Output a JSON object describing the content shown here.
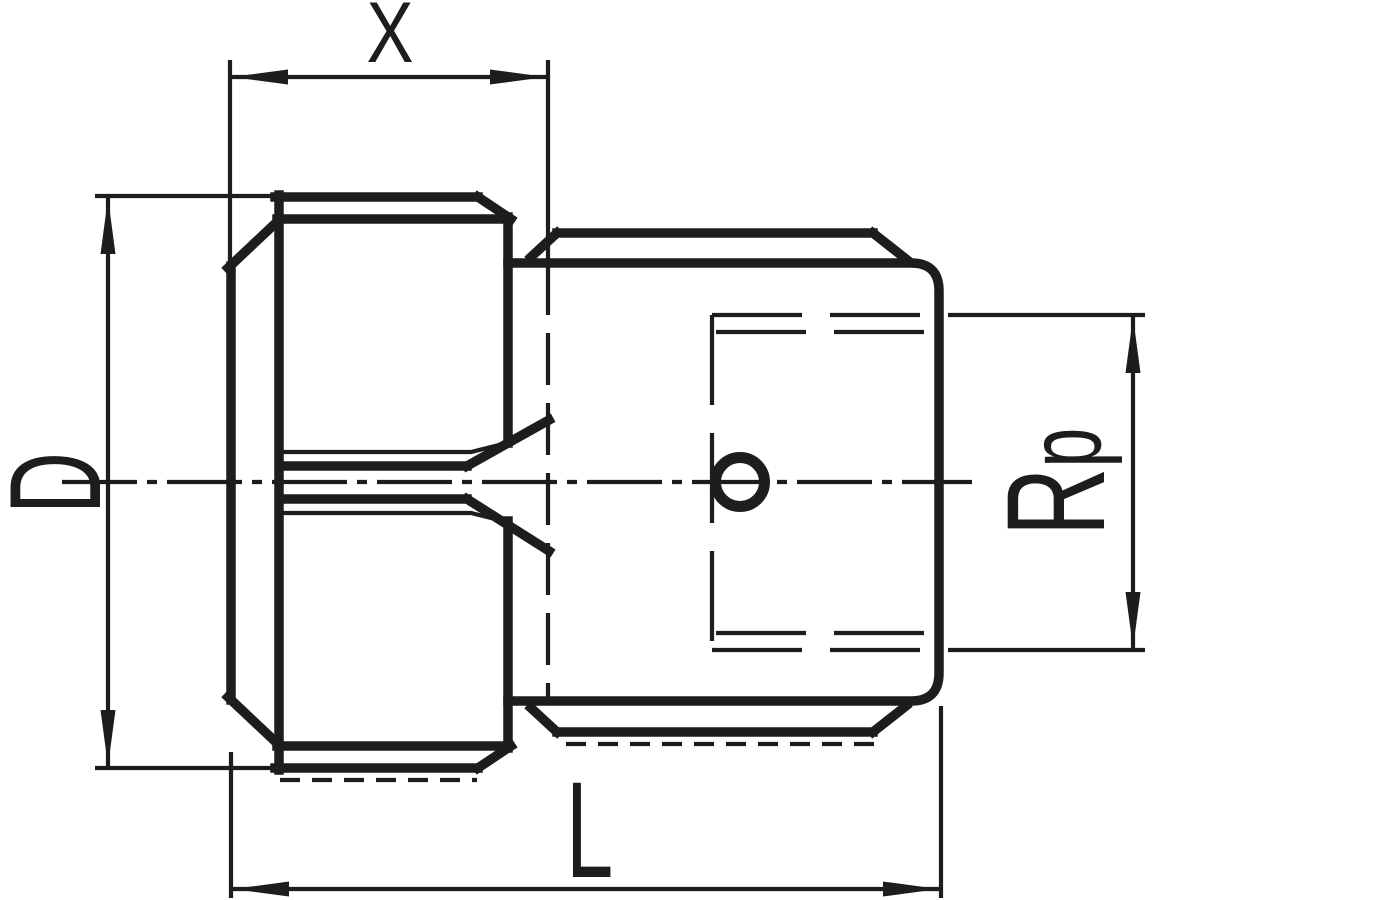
{
  "drawing": {
    "type": "technical-dimension-drawing",
    "background_color": "#ffffff",
    "line_color": "#1d1d1b",
    "labels": {
      "x": "X",
      "d": "D",
      "l": "L",
      "rp_main": "R",
      "rp_sub": "p"
    }
  }
}
